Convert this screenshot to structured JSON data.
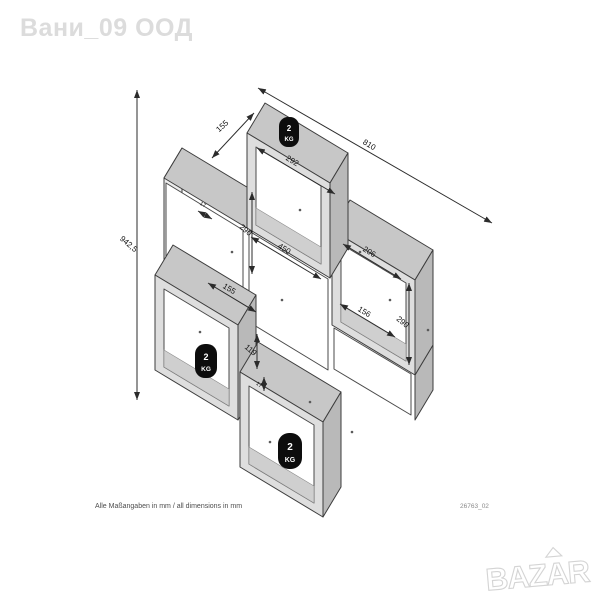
{
  "seller_watermark": "Вани_09 ООД",
  "site_logo": "BAZAR",
  "footer": {
    "note": "Alle Maßangaben in mm / all dimensions in mm",
    "code": "26763_02"
  },
  "badges": [
    {
      "value": "2",
      "unit": "KG"
    },
    {
      "value": "2",
      "unit": "KG"
    },
    {
      "value": "2",
      "unit": "KG"
    }
  ],
  "dimensions": {
    "total_height": "942,5",
    "depth": "155",
    "total_width": "810",
    "top_compartment_width": "292",
    "top_compartment_height": "290",
    "middle_opening_width": "450",
    "right_compartment_width": "206",
    "right_compartment_height": "290",
    "right_inner_width": "156",
    "left_inner_width": "155",
    "inner_height": "119",
    "panel_thickness_a": "17",
    "panel_thickness_b": "17"
  }
}
